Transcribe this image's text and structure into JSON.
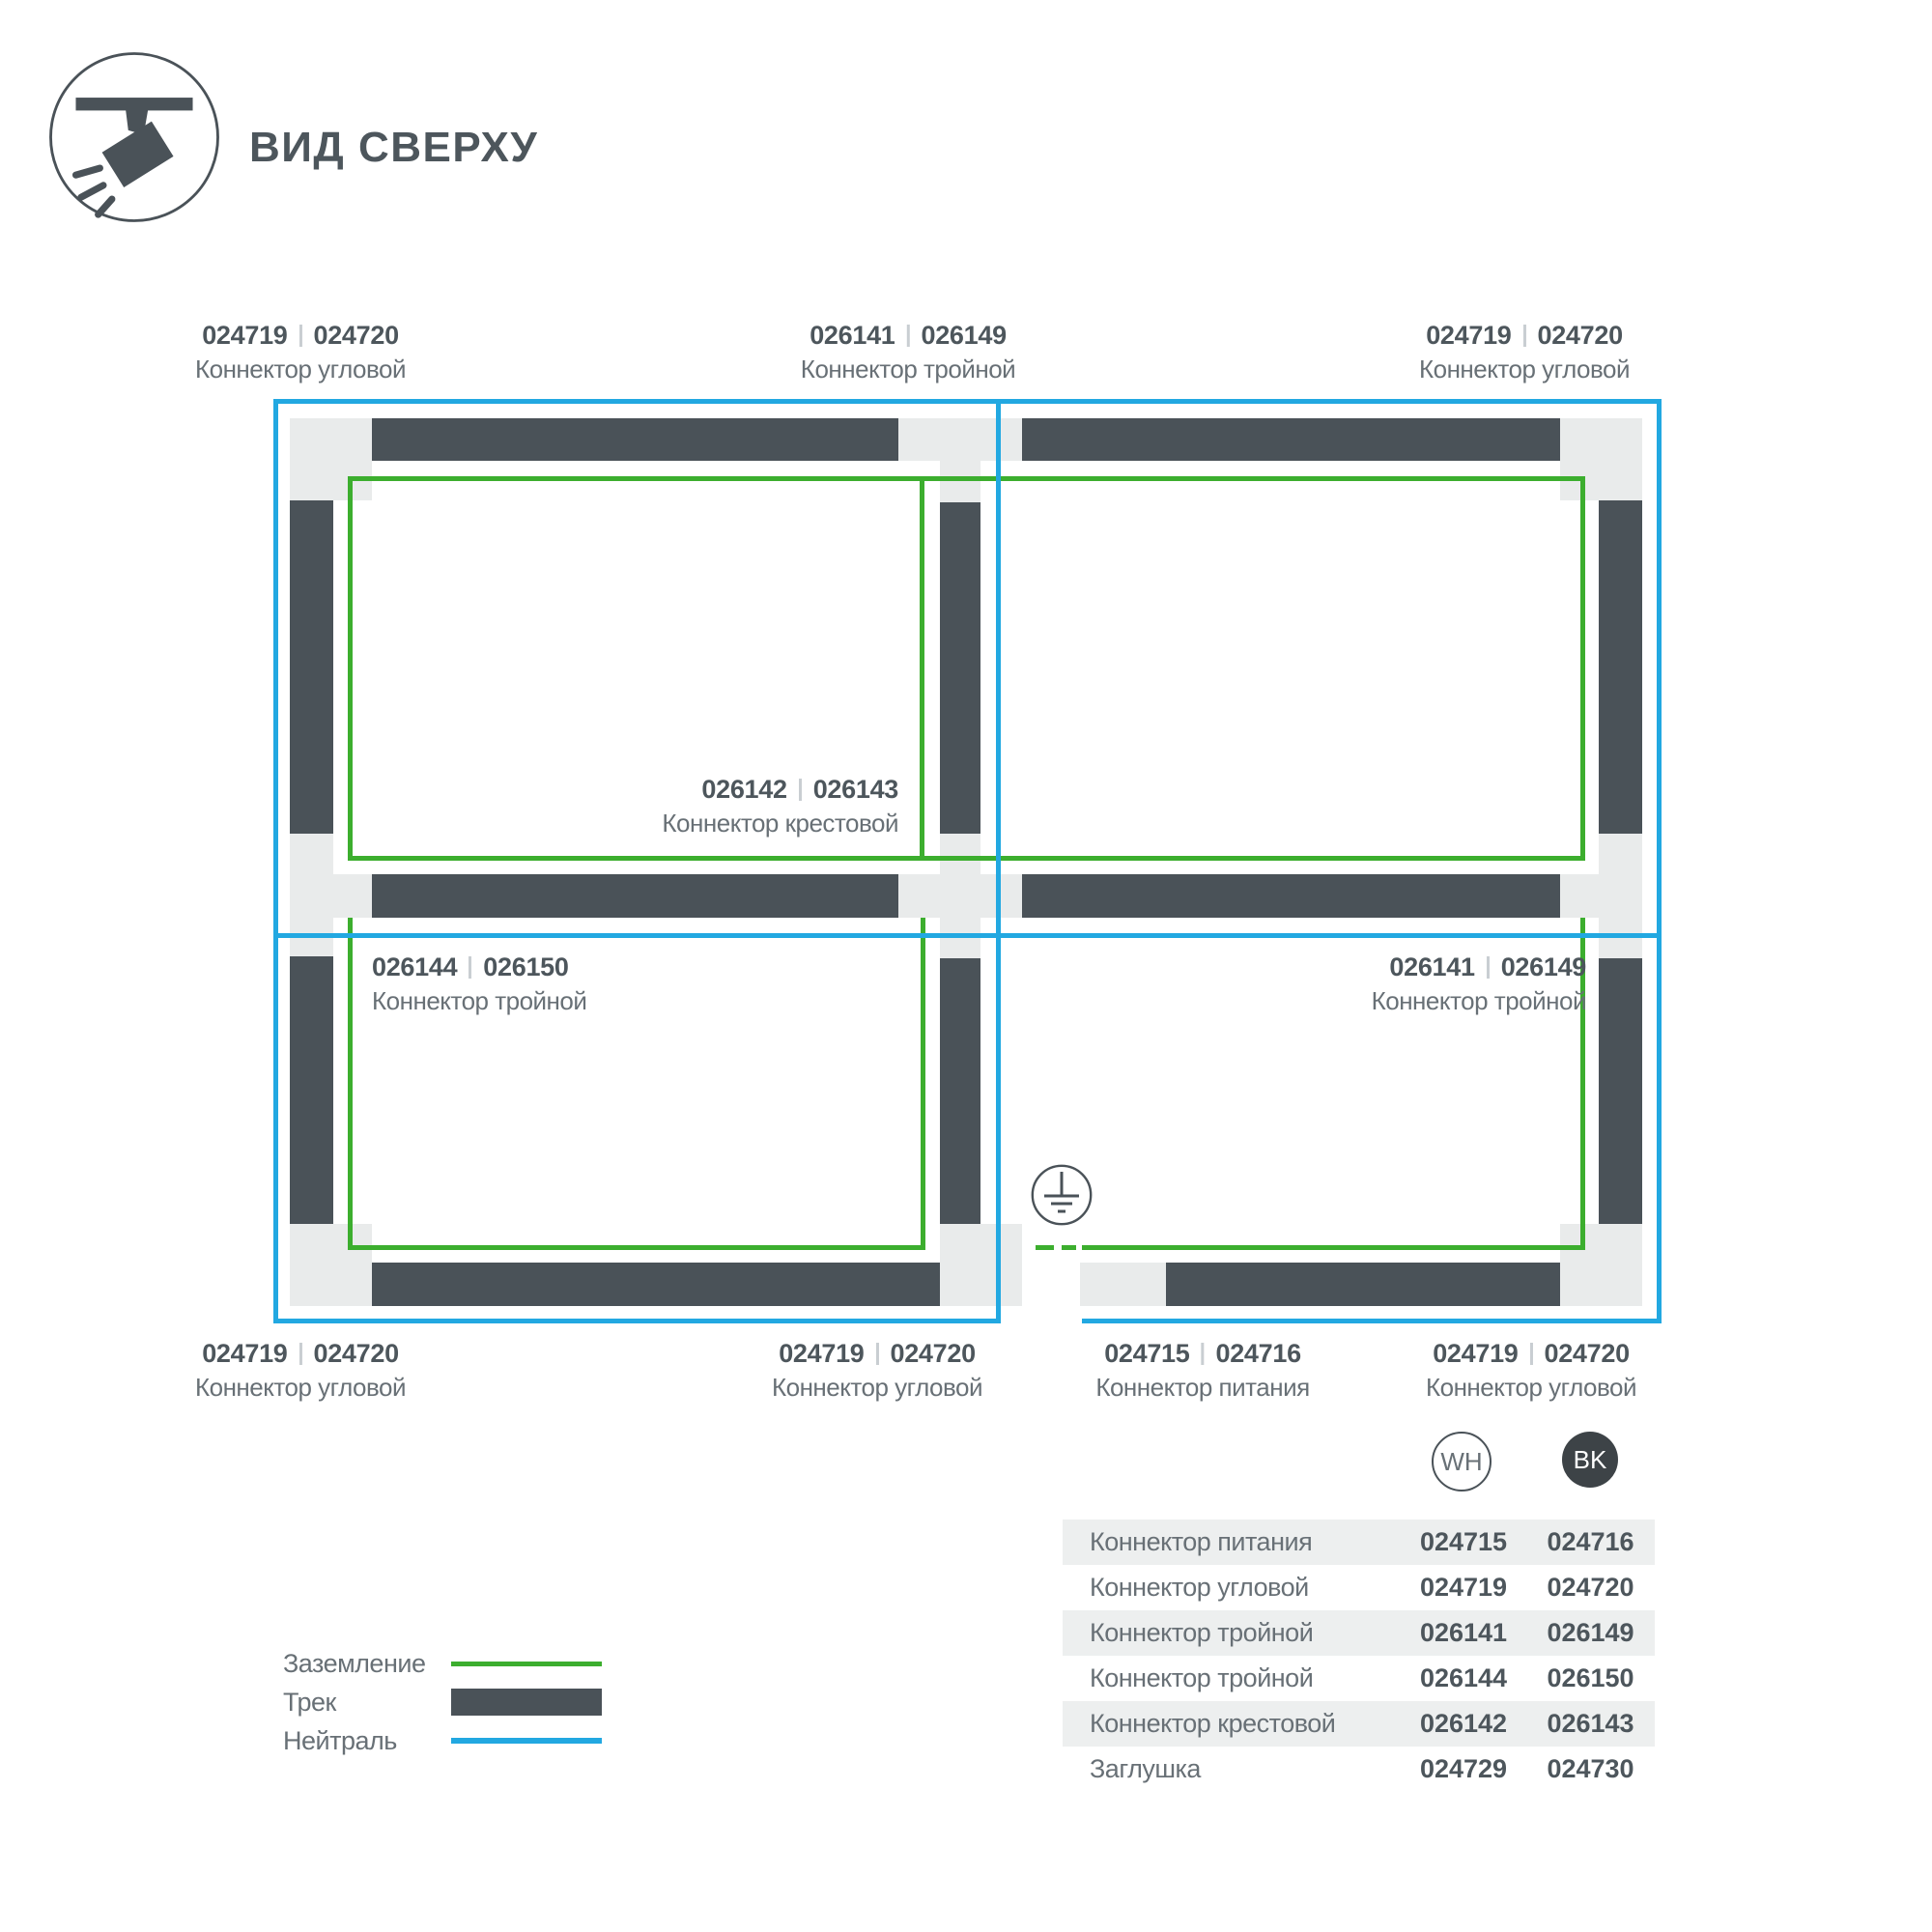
{
  "header": {
    "title": "ВИД СВЕРХУ"
  },
  "colors": {
    "ground": "#3cae2e",
    "neutral": "#22a8e1",
    "track": "#4a5258",
    "connector": "#e9ebeb",
    "row-alt": "#edefef",
    "text-dark": "#4d565c",
    "text-muted": "#687076",
    "badge-bk": "#3d4347",
    "divider": "#c9ced2"
  },
  "diagram": {
    "callouts": [
      {
        "wh": "024719",
        "bk": "024720",
        "name": "Коннектор угловой"
      },
      {
        "wh": "026141",
        "bk": "026149",
        "name": "Коннектор тройной"
      },
      {
        "wh": "024719",
        "bk": "024720",
        "name": "Коннектор угловой"
      },
      {
        "wh": "026142",
        "bk": "026143",
        "name": "Коннектор крестовой"
      },
      {
        "wh": "026144",
        "bk": "026150",
        "name": "Коннектор тройной"
      },
      {
        "wh": "026141",
        "bk": "026149",
        "name": "Коннектор тройной"
      },
      {
        "wh": "024719",
        "bk": "024720",
        "name": "Коннектор угловой"
      },
      {
        "wh": "024719",
        "bk": "024720",
        "name": "Коннектор угловой"
      },
      {
        "wh": "024715",
        "bk": "024716",
        "name": "Коннектор питания"
      },
      {
        "wh": "024719",
        "bk": "024720",
        "name": "Коннектор угловой"
      }
    ],
    "legend": [
      {
        "label": "Заземление",
        "type": "ground-line"
      },
      {
        "label": "Трек",
        "type": "track-bar"
      },
      {
        "label": "Нейтраль",
        "type": "neutral-line"
      }
    ]
  },
  "table": {
    "col_wh": "WH",
    "col_bk": "BK",
    "rows": [
      {
        "name": "Коннектор питания",
        "wh": "024715",
        "bk": "024716"
      },
      {
        "name": "Коннектор угловой",
        "wh": "024719",
        "bk": "024720"
      },
      {
        "name": "Коннектор тройной",
        "wh": "026141",
        "bk": "026149"
      },
      {
        "name": "Коннектор тройной",
        "wh": "026144",
        "bk": "026150"
      },
      {
        "name": "Коннектор крестовой",
        "wh": "026142",
        "bk": "026143"
      },
      {
        "name": "Заглушка",
        "wh": "024729",
        "bk": "024730"
      }
    ]
  }
}
